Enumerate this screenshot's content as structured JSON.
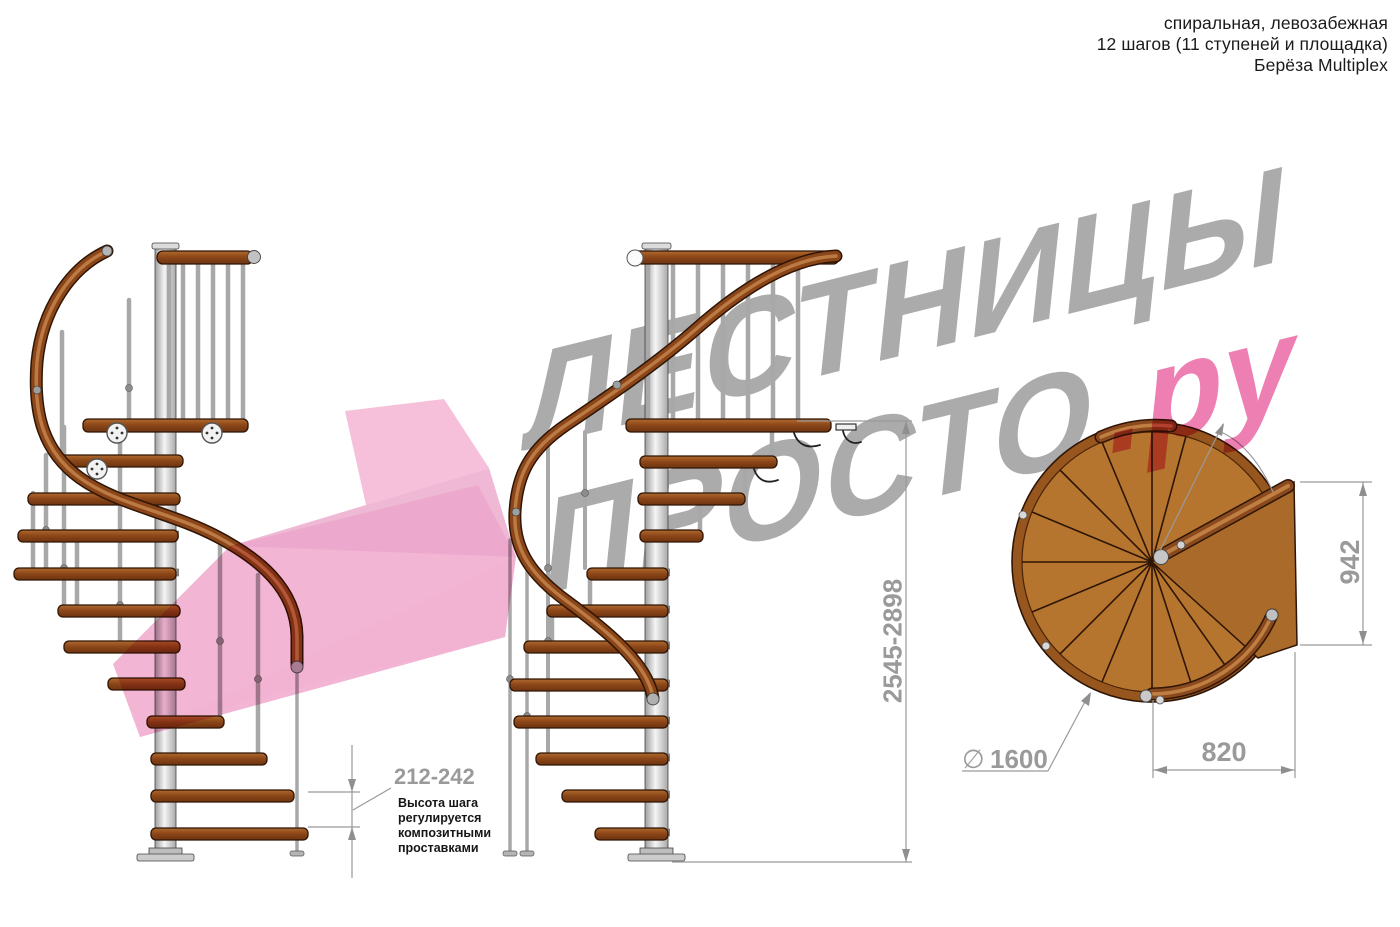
{
  "header": {
    "line1": "спиральная, левозабежная",
    "line2": "12 шагов (11 ступеней и площадка)",
    "line3": "Берёза Multiplex"
  },
  "watermark": {
    "brand_line1": "ЛЕСТНИЦЫ",
    "brand_line2": "ПРОСТО",
    "brand_line2_suffix": ".ру"
  },
  "annotations": {
    "step_height_value": "212-242",
    "step_height_note": [
      "Высота шага",
      "регулируется",
      "композитными",
      "проставками"
    ],
    "total_height_value": "2545-2898",
    "plan_width_value": "942",
    "plan_depth_value": "820",
    "diameter_symbol": "∅",
    "diameter_value": "1600"
  },
  "colors": {
    "watermark_gray": "#ababab",
    "watermark_pink": "#ee7fb2",
    "arrow_pink": "#f5bcd9",
    "wood": "#8a4518",
    "wood_plan": "#b5752f",
    "metal_pole": "#c9c9c9",
    "dimension_gray": "#9a9a9a"
  }
}
